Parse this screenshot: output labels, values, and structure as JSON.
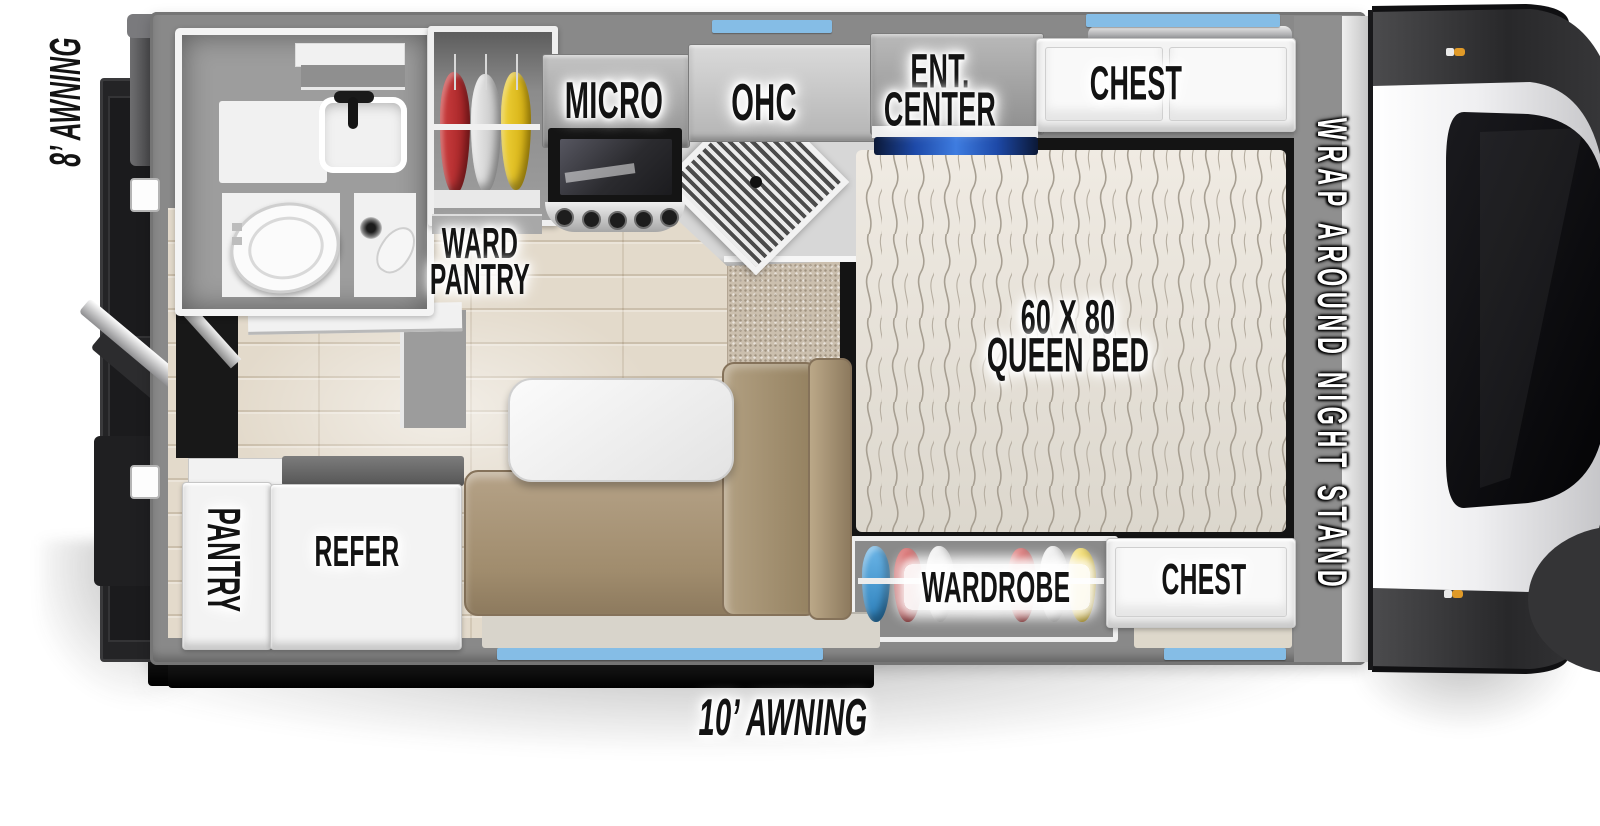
{
  "floorplan": {
    "labels": {
      "awning_left": "8’ AWNING",
      "awning_bottom": "10’ AWNING",
      "ward_pantry_line1": "WARD",
      "ward_pantry_line2": "PANTRY",
      "micro": "MICRO",
      "ohc": "OHC",
      "ent_center_line1": "ENT.",
      "ent_center_line2": "CENTER",
      "chest_top": "CHEST",
      "bed_line1": "60 X 80",
      "bed_line2": "QUEEN BED",
      "night_stand": "WRAP AROUND NIGHT STAND",
      "wardrobe": "WARDROBE",
      "chest_bottom": "CHEST",
      "pantry": "PANTRY",
      "refer": "REFER"
    },
    "colors": {
      "awning_window_strip": "#85bde6",
      "tv_accent": "#2f6fd8",
      "sofa_tan": "#a28e71",
      "wall_gray": "#898989",
      "clothes_red": "#b22a2a",
      "clothes_yellow": "#e5c216",
      "clothes_blue": "#3f9bd8",
      "clothes_white": "#e0e0e0"
    }
  }
}
